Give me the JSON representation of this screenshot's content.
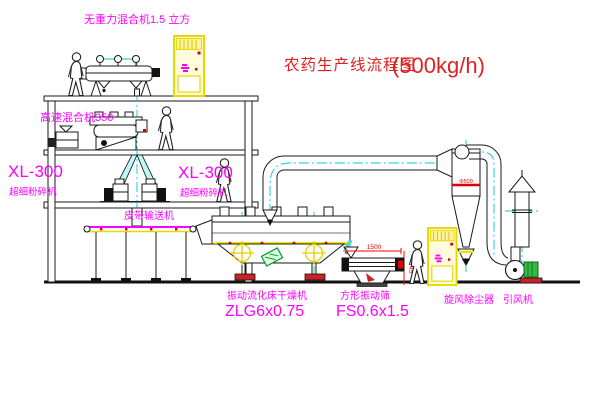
{
  "title": {
    "name": "农药生产线流程图",
    "capacity": "(500kg/h)"
  },
  "equipment_labels": {
    "gravity_mixer": "无重力混合机1.5 立方",
    "high_speed_mixer": "高速混合机350",
    "left_mill": {
      "model": "XL-300",
      "name": "超细粉碎机"
    },
    "center_mill": {
      "model": "XL-300",
      "name": "超细粉碎机"
    },
    "belt_conveyor": "皮带输送机",
    "fluid_bed_dryer": {
      "name": "振动流化床干燥机",
      "model": "ZLG6x0.75"
    },
    "vibrating_sieve": {
      "name": "方形振动筛",
      "model": "FS0.6x1.5"
    },
    "cyclone": "旋风除尘器",
    "induced_draft_fan": "引风机"
  },
  "dimensions": {
    "sieve_length": "1500",
    "sieve_height": "745",
    "cyclone_band": "Φ500"
  },
  "colors": {
    "label_magenta": "#ff00ff",
    "title_red": "#cc2222",
    "dimension_red": "#ff0000",
    "centerline_cyan": "#00cccc",
    "cabinet_yellow": "#e8d800",
    "pipe_cyan": "#59d5d5",
    "motor_green": "#33bb44"
  }
}
